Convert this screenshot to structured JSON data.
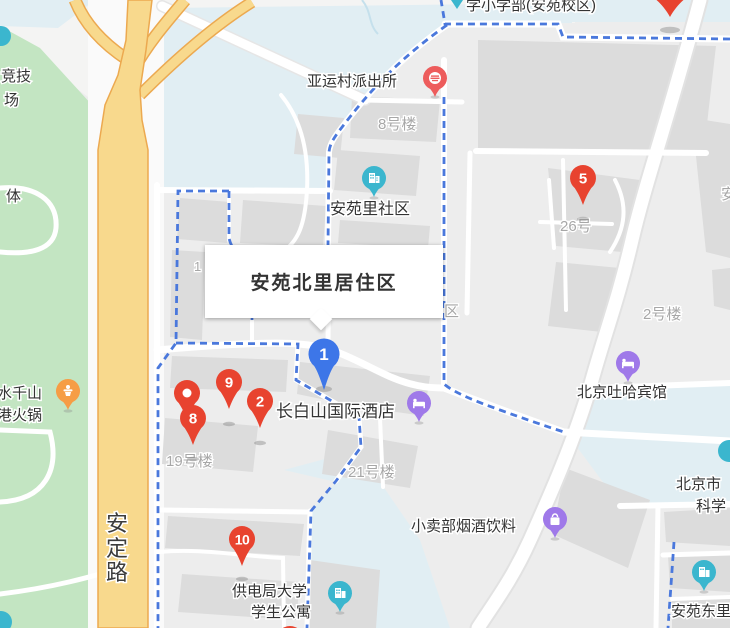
{
  "info_box": {
    "title": "安苑北里居住区"
  },
  "markers": {
    "m1": {
      "label": "1",
      "color": "#3D76E8",
      "type": "selected-location"
    },
    "m2": {
      "label": "2",
      "color": "#E8432F"
    },
    "m5": {
      "label": "5",
      "color": "#E8432F"
    },
    "m8": {
      "label": "8",
      "color": "#E8432F"
    },
    "m9": {
      "label": "9",
      "color": "#E8432F"
    },
    "m10": {
      "label": "10",
      "color": "#E8432F"
    }
  },
  "place_labels": {
    "school_top": "学小学部(安苑校区)",
    "police": "亚运村派出所",
    "community": "安苑里社区",
    "hotel_changbaishan": "长白山国际酒店",
    "hotel_tuha": "北京吐哈宾馆",
    "shop": "小卖部烟酒饮料",
    "dorm_line1": "供电局大学",
    "dorm_line2": "学生公寓",
    "beijing_line1": "北京市",
    "beijing_line2": "科学",
    "dongli": "安苑东里",
    "hotpot_line1": "水千山",
    "hotpot_line2": "港火锅",
    "jingji": "竞技",
    "chang": "场",
    "ti": "体",
    "anding_road": [
      "安",
      "定",
      "路"
    ]
  },
  "building_labels": {
    "b8": "8号楼",
    "b26": "26号",
    "b2": "2号楼",
    "b19": "19号楼",
    "b21": "21号楼",
    "qu_partial": "区",
    "one_partial": "1",
    "an_partial": "安"
  },
  "colors": {
    "marker_red": "#E8432F",
    "marker_blue": "#3D76E8",
    "poi_purple": "#9F79E9",
    "poi_teal": "#3BB6CE",
    "poi_salmon": "#ED5C5C",
    "poi_orange": "#F69D45",
    "boundary_dash_blue": "#4A78DC",
    "park_green": "#C3E5C2",
    "campus_blue": "#E1EEF3",
    "highway_yellow": "#F8D98D",
    "highway_casing": "#ECA950",
    "building_gray": "#DCDCDC",
    "label_gray": "#A7A7A7"
  }
}
